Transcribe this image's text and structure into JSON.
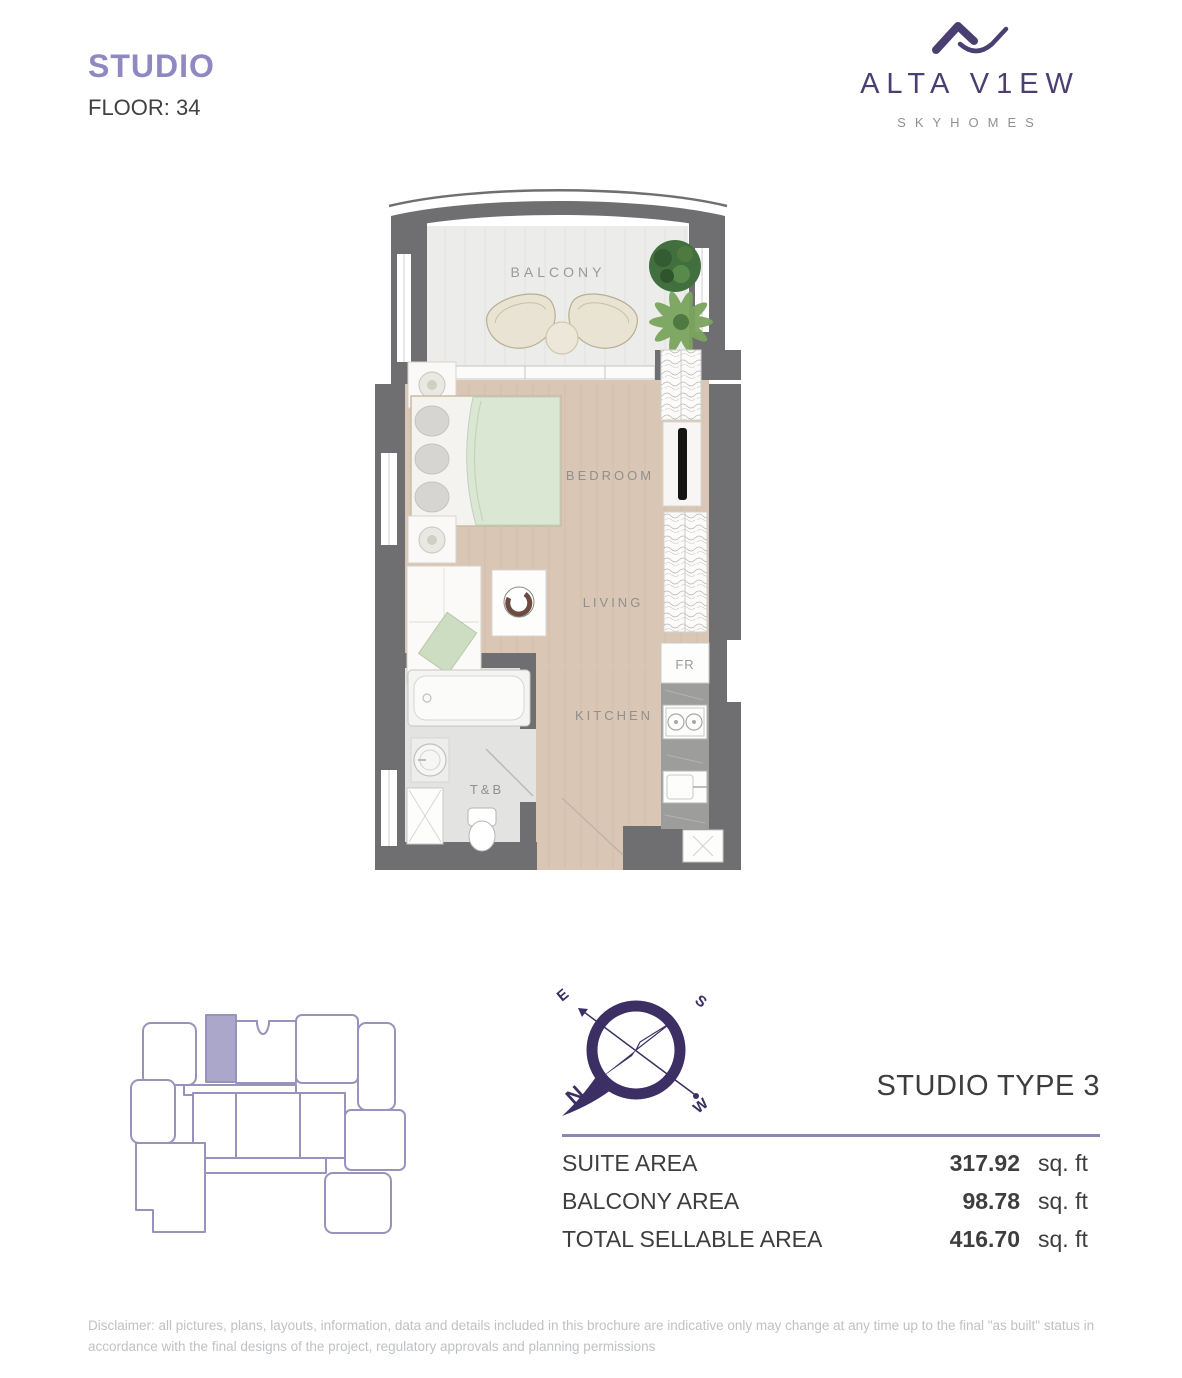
{
  "header": {
    "unit_type": "STUDIO",
    "floor_label": "FLOOR: 34",
    "brand": {
      "name": "ALTA V1EW",
      "tagline": "SKYHOMES"
    }
  },
  "floor_plan": {
    "labels": {
      "balcony": "BALCONY",
      "bedroom": "BEDROOM",
      "living": "LIVING",
      "kitchen": "KITCHEN",
      "bath": "T&B",
      "fridge": "FR"
    }
  },
  "compass": {
    "north": "N",
    "south": "S",
    "east": "E",
    "west": "W"
  },
  "unit_info": {
    "title": "STUDIO TYPE 3",
    "rows": [
      {
        "label": "SUITE AREA",
        "value": "317.92",
        "unit": "sq. ft"
      },
      {
        "label": "BALCONY AREA",
        "value": "98.78",
        "unit": "sq. ft"
      },
      {
        "label": "TOTAL SELLABLE AREA",
        "value": "416.70",
        "unit": "sq. ft"
      }
    ]
  },
  "disclaimer": "Disclaimer: all pictures, plans, layouts, information, data and details included in this brochure are indicative only may change at any time up to the final \"as built\" status in accordance with the final designs of the project, regulatory approvals and planning permissions",
  "colors": {
    "accent_purple": "#8e89c1",
    "brand_purple": "#4b3f72",
    "compass_purple": "#3c2f63",
    "keyplan_stroke": "#9793ba",
    "keyplan_highlight": "#aba7cb",
    "divider_purple": "#8b87b3",
    "wall_gray": "#6f6f71",
    "floor_beige": "#d9c6b4",
    "balcony_floor": "#ecedeb",
    "bath_floor": "#e3e3e1",
    "blanket_green": "#d9e7d3",
    "text_dark": "#3e3e3e",
    "label_gray": "#8f8f8d"
  }
}
